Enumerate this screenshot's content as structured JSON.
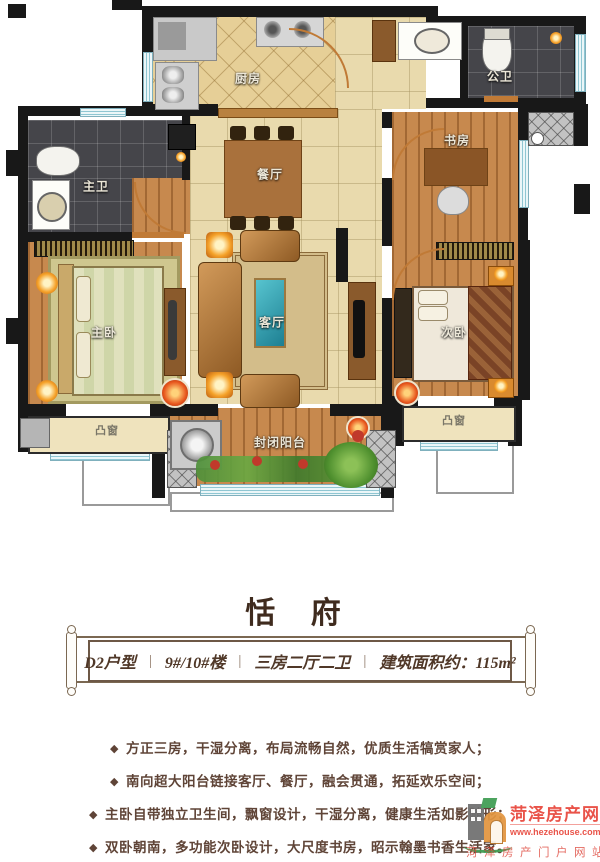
{
  "title": {
    "text": "恬 府"
  },
  "banner": {
    "separator": "|",
    "segments": [
      "D2户型",
      "9#/10#楼",
      "三房二厅二卫",
      "建筑面积约：115m²"
    ]
  },
  "features": {
    "bullet": "◆",
    "items": [
      "方正三房，干湿分离，布局流畅自然，优质生活犒赏家人；",
      "南向超大阳台链接客厅、餐厅，融会贯通，拓延欢乐空间；",
      "主卧自带独立卫生间，飘窗设计，干湿分离，健康生活如影随形；",
      "双卧朝南，多功能次卧设计，大尺度书房，昭示翰墨书香生活家。"
    ]
  },
  "plan": {
    "rooms": {
      "kitchen": "厨房",
      "public_bath": "公卫",
      "master_bath": "主卫",
      "dining": "餐厅",
      "study": "书房",
      "living": "客厅",
      "master_bedroom": "主卧",
      "second_bedroom": "次卧",
      "balcony": "封闭阳台",
      "bay_window_left": "凸窗",
      "bay_window_right": "凸窗"
    }
  },
  "logo": {
    "site_name": "菏泽房产网",
    "site_url": "www.hezehouse.com",
    "tagline": "菏泽房产门户网站"
  },
  "colors": {
    "wall": "#181818",
    "tile_floor": "#e9daad",
    "dark_tile": "#45454a",
    "wood_floor": "#c7894e",
    "window": "#bfe3ec",
    "accent_red": "#e8473c",
    "text_brown": "#5f4437"
  }
}
